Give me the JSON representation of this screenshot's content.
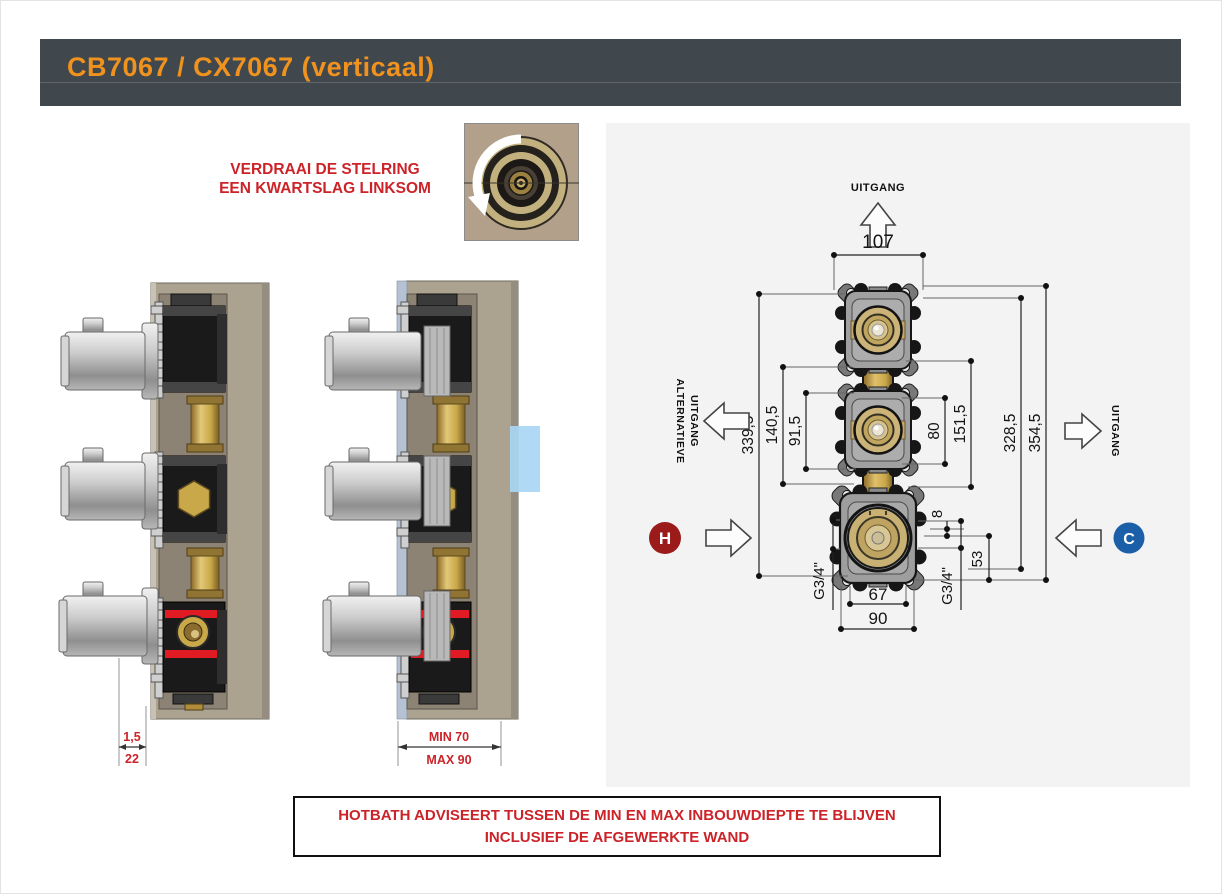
{
  "header": {
    "title": "CB7067 / CX7067 (verticaal)"
  },
  "instruction": {
    "line1": "VERDRAAI DE STELRING",
    "line2": "EEN KWARTSLAG LINKSOM"
  },
  "side_view_wall": {
    "dim_thin": "1,5",
    "dim_thick": "22"
  },
  "side_view_depth": {
    "dim_min": "MIN 70",
    "dim_max": "MAX 90"
  },
  "diagram": {
    "label_outlet_top": "UITGANG",
    "label_alt_outlet_line1": "ALTERNATIEVE",
    "label_alt_outlet_line2": "UITGANG",
    "label_outlet_right": "UITGANG",
    "label_hot": "H",
    "label_cold": "C",
    "dims": {
      "width_top": "107",
      "total_left": "339,5",
      "mid_left": "140,5",
      "inner_left": "91,5",
      "inner_right": "80",
      "mid_right": "151,5",
      "outer_right_inner": "328,5",
      "outer_right_outer": "354,5",
      "offset_small": "8",
      "offset_large": "53",
      "width_bottom_inner": "67",
      "width_bottom_outer": "90",
      "thread_left": "G3/4\"",
      "thread_right": "G3/4\""
    }
  },
  "warning": {
    "line1": "HOTBATH ADVISEERT TUSSEN DE MIN EN MAX INBOUWDIEPTE TE BLIJVEN",
    "line2": "INCLUSIEF DE AFGEWERKTE WAND"
  },
  "colors": {
    "accent_orange": "#f0921e",
    "alert_red": "#cc2329",
    "hot_red": "#9b1b1b",
    "cold_blue": "#1a5fa8",
    "header_slate": "#40474d",
    "panel_gray": "#f3f3f3",
    "brass": "#c9a84a",
    "wall_tan": "#aba290",
    "highlight_blue": "#a9d6f4"
  }
}
